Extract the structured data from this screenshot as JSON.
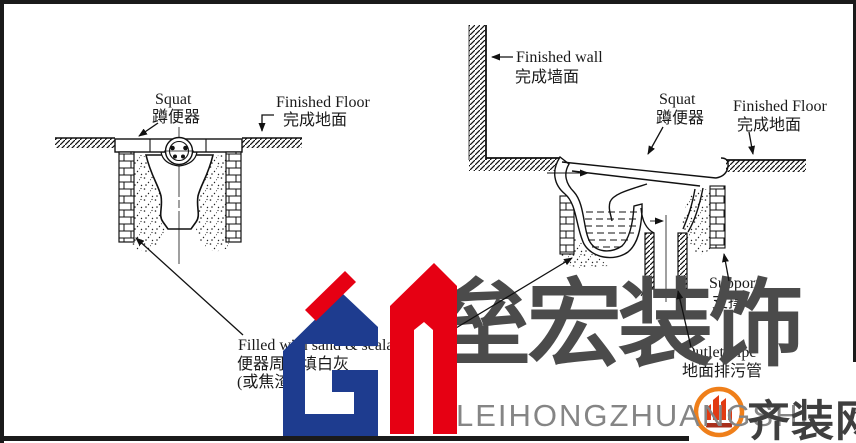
{
  "frame": {
    "border_color": "#1a1a1a"
  },
  "left_diagram": {
    "labels": {
      "squat_en": "Squat",
      "squat_cn": "蹲便器",
      "finished_floor_en": "Finished Floor",
      "finished_floor_cn": "完成地面",
      "fill_en": "Filled with sand & sealant",
      "fill_cn_1": "便器周围填白灰",
      "fill_cn_2": "(或焦渣)"
    }
  },
  "right_diagram": {
    "labels": {
      "finished_wall_en": "Finished wall",
      "finished_wall_cn": "完成墙面",
      "squat_en": "Squat",
      "squat_cn": "蹲便器",
      "finished_floor_en": "Finished Floor",
      "finished_floor_cn": "完成地面",
      "support_en": "Support",
      "support_cn": "支撑",
      "outlet_pipe_en": "Outlet Pipe",
      "outlet_pipe_cn": "地面排污管"
    }
  },
  "watermark": {
    "brand_cn": "垒宏装饰",
    "brand_pinyin": "LEIHONGZHUANGSHI",
    "site_name_cn": "齐装网",
    "logo_monogram": "Gh",
    "colors": {
      "logo_blue": "#1e3c8f",
      "logo_red": "#e60013",
      "brand_gray": "#4b4b4b",
      "pinyin_gray": "#858585",
      "site_gray": "#3f3f3f",
      "badge_orange": "#ef7f1a"
    }
  }
}
